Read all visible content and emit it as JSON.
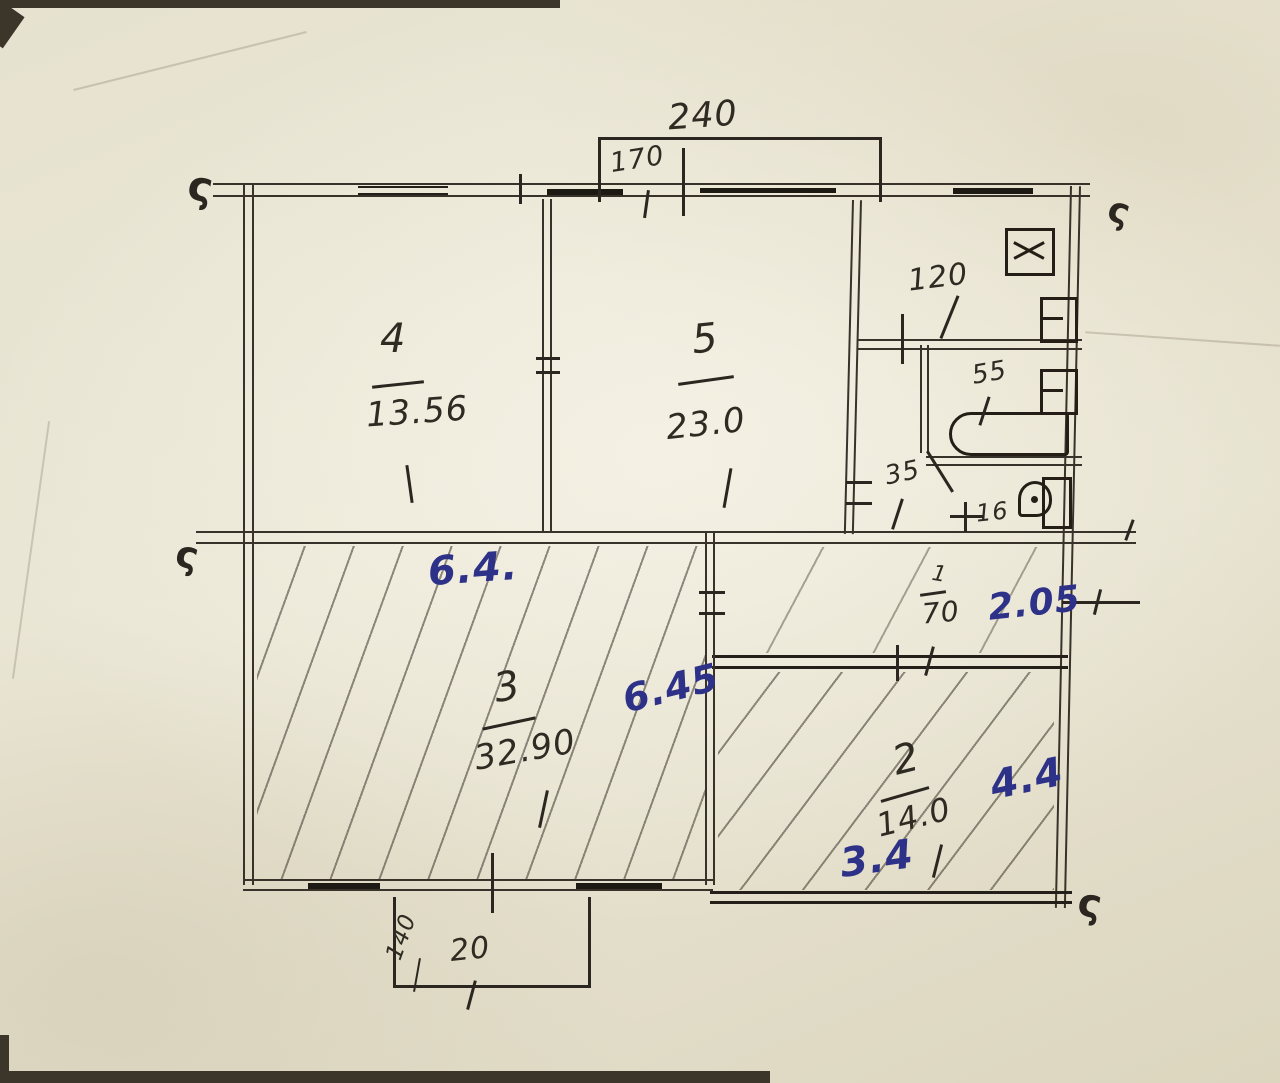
{
  "meta": {
    "description": "Hand-drawn apartment floor plan, pencil on paper with blue ink dimensions"
  },
  "rooms": {
    "room4": {
      "number": "4",
      "area": "13.56"
    },
    "room5": {
      "number": "5",
      "area": "23.0"
    },
    "room3": {
      "number": "3",
      "area": "32.90"
    },
    "room2": {
      "number": "2",
      "area": "14.0"
    }
  },
  "pencil_dims": {
    "balcony_top_width": "240",
    "balcony_top_depth": "170",
    "bathroom_width": "120",
    "bath_fixture": "55",
    "bath_door": "35",
    "wc_width": "16",
    "hall_numerator": "1",
    "hall_width": "70",
    "balcony_bottom_depth": "140",
    "balcony_bottom_width": "20"
  },
  "ink_dims": {
    "corridor_width": "6.4.",
    "room3_width": "6.45",
    "hall_width": "2.05",
    "room2_width": "4.4",
    "room2_depth": "3.4"
  },
  "section_mark": "ς",
  "colors": {
    "pencil": "#332d26",
    "ink_blue": "#2d3187",
    "paper": "#e7e3d1"
  }
}
